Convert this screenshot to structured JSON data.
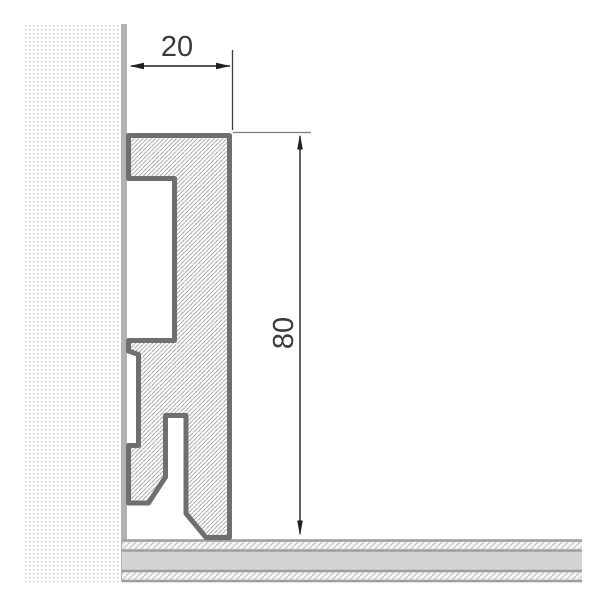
{
  "drawing": {
    "type": "skirting-board-profile-cross-section",
    "dimensions": {
      "width": {
        "label": "20"
      },
      "height": {
        "label": "80"
      }
    },
    "colors": {
      "profile_outline": "#6f6f6f",
      "profile_hatch_line": "#9a9a9a",
      "wall_dot": "#c9c9c9",
      "wall_surface_strip": "#b2b2b2",
      "floor_fill": "#d4d4d4",
      "floor_border": "#9e9e9e",
      "floor_hatch_line": "#bdbdbd",
      "dimension_ink": "#1f1f1f",
      "background": "#ffffff"
    }
  }
}
